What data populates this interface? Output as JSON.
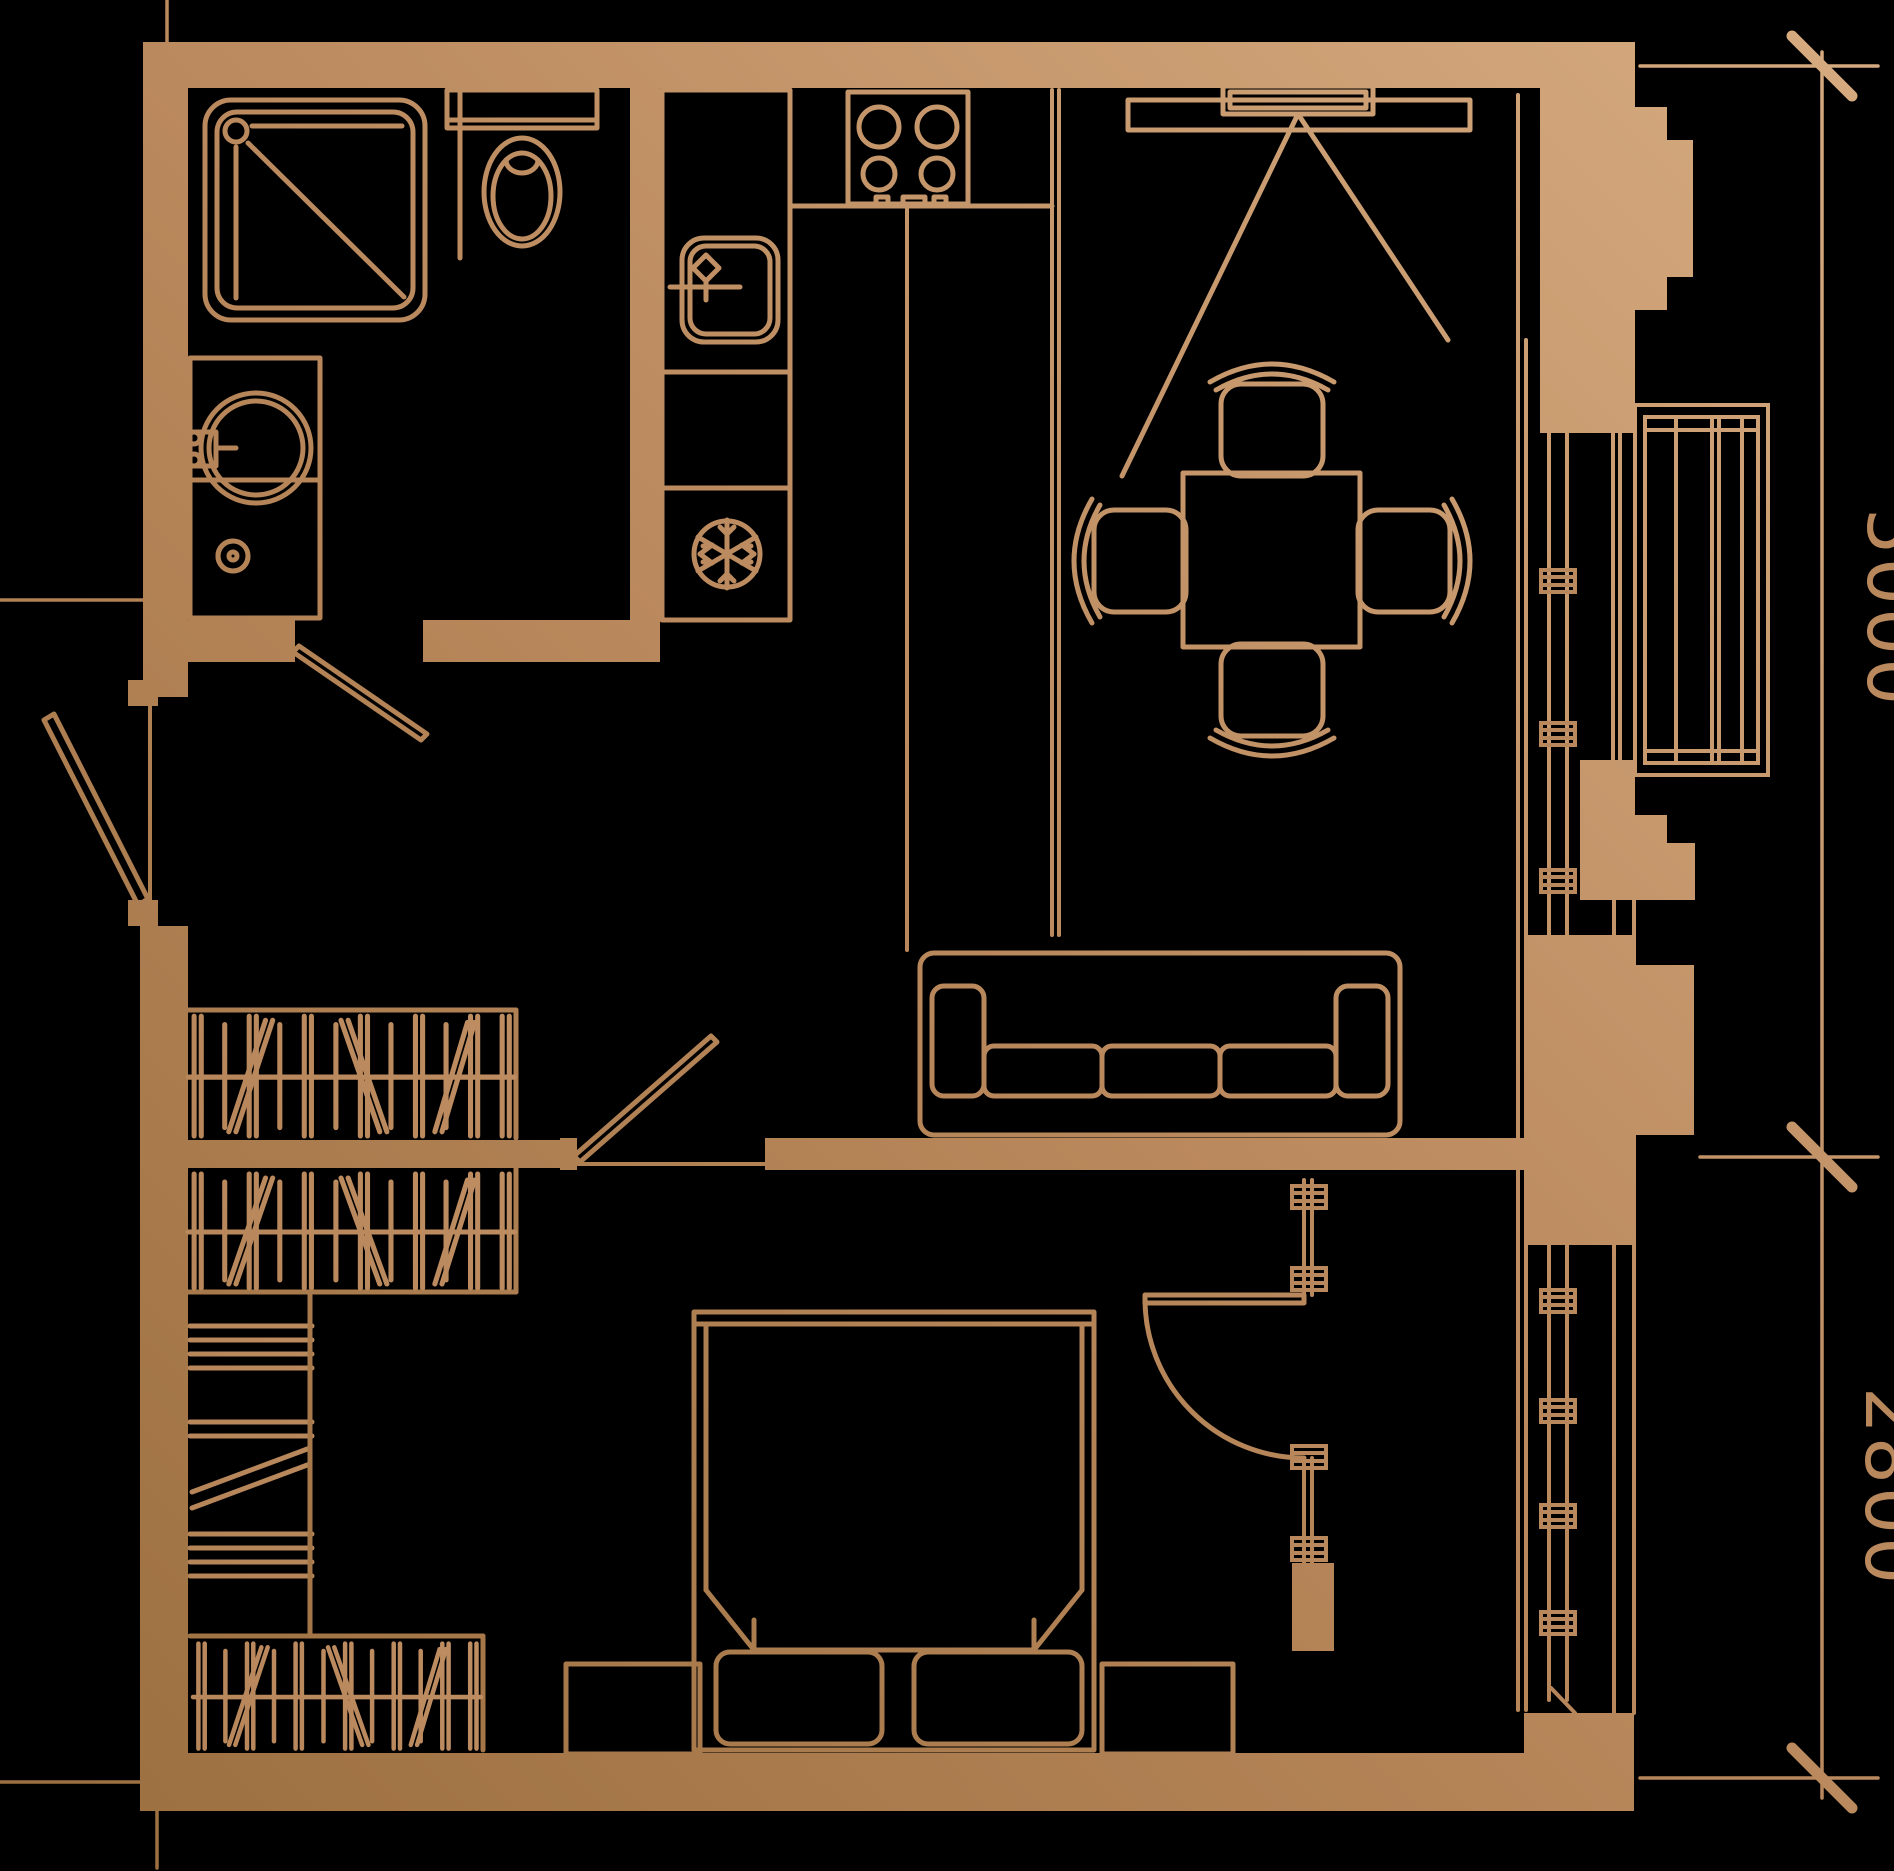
{
  "palette": {
    "background": "#000000",
    "copper_light": "#d7ac81",
    "copper_mid": "#b9885c",
    "copper_dark": "#9a6e3e"
  },
  "dimension_labels": {
    "vertical_upper": "5000",
    "vertical_lower": "2800"
  },
  "fixtures": {
    "bathroom": [
      "shower",
      "toilet",
      "washbasin",
      "washing-machine"
    ],
    "kitchen": [
      "counter",
      "sink",
      "stove",
      "refrigerator"
    ],
    "living": [
      "tv-console",
      "tv",
      "dining-table",
      "dining-chairs",
      "sofa"
    ],
    "bedroom": [
      "double-bed",
      "pillows",
      "nightstands",
      "glass-partition",
      "swing-door"
    ],
    "wardrobe": [
      "coat-rack",
      "hanging-rails",
      "shelf-stack"
    ],
    "windows": [
      "balcony-window",
      "living-glazing",
      "bedroom-glazing"
    ]
  }
}
